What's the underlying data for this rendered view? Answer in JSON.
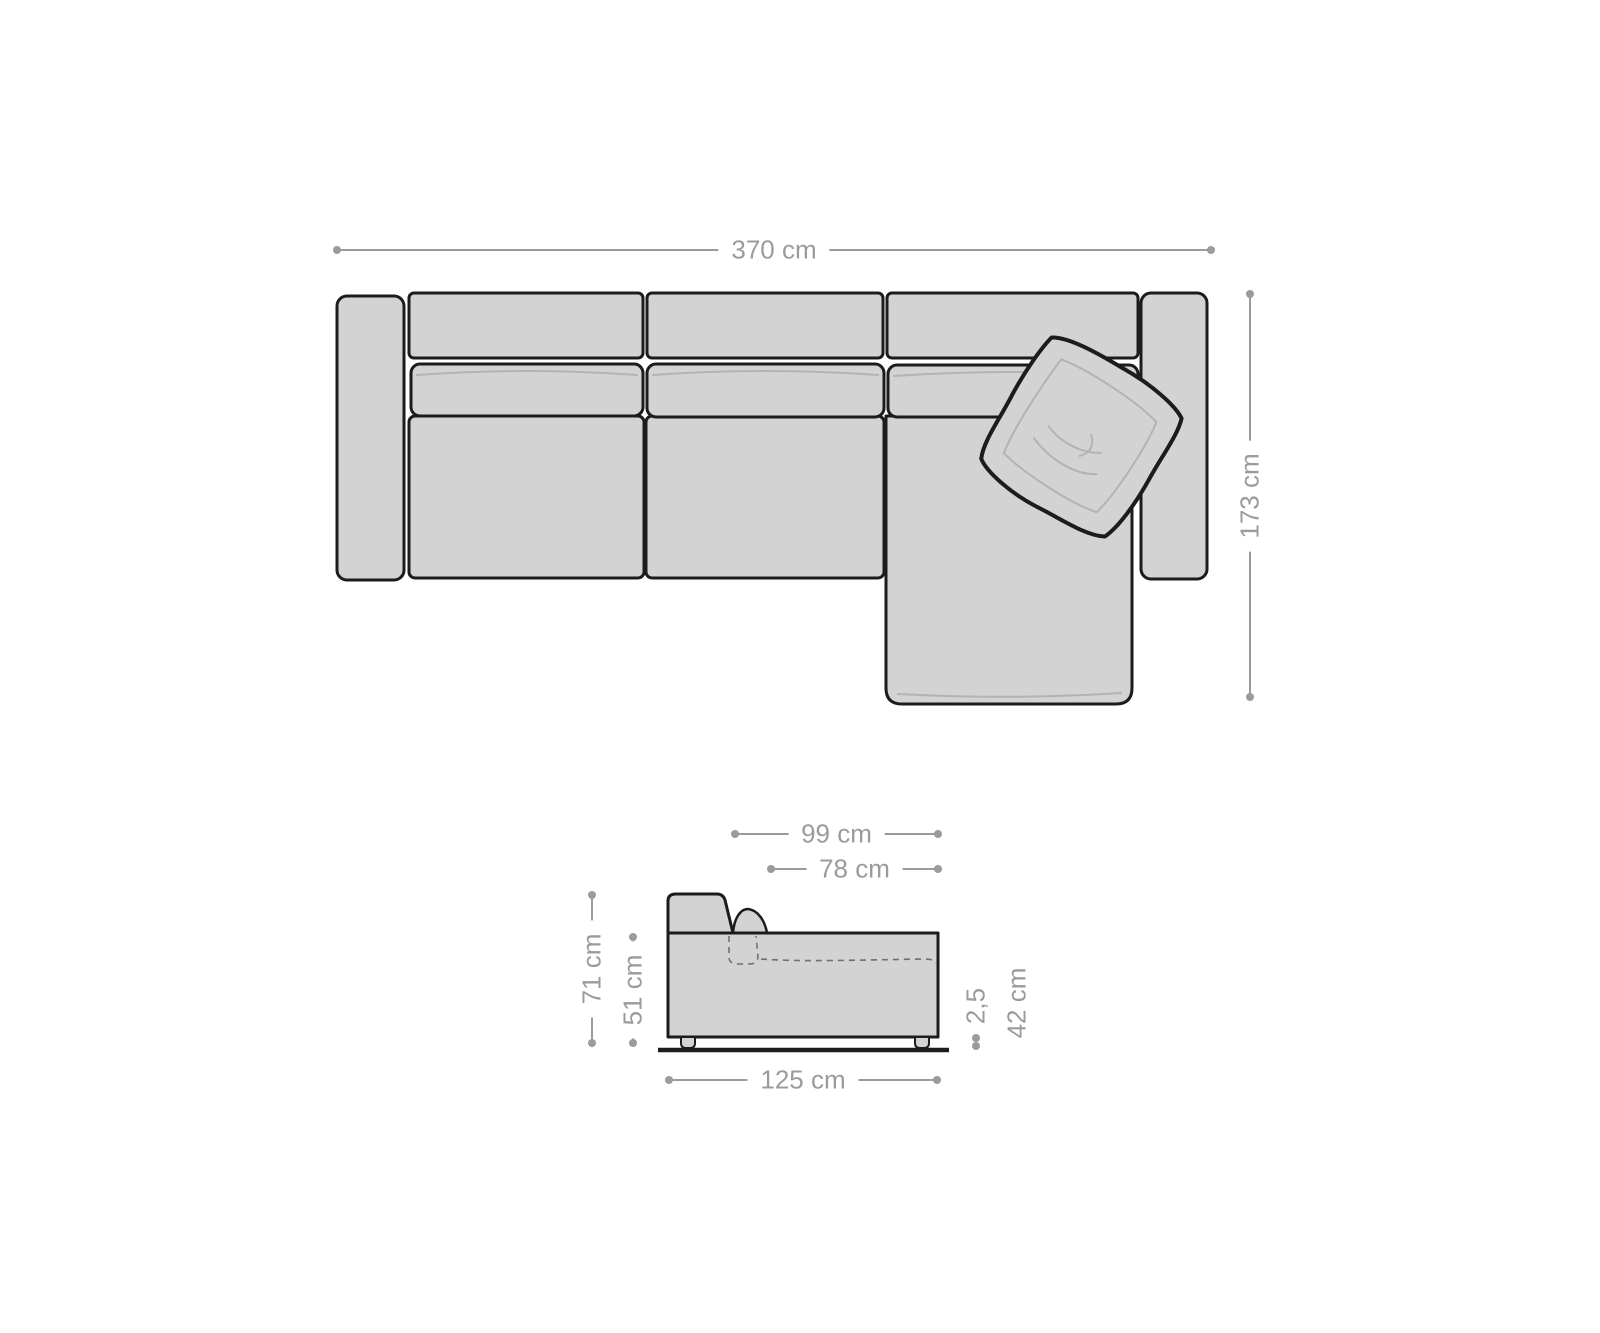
{
  "page": {
    "background": "#ffffff",
    "description_labels_units": "cm"
  },
  "colors": {
    "outline": "#1c1c1c",
    "sofa_fill": "#d3d3d3",
    "dimension_gray": "#9b9b9b",
    "seam_gray": "#b3b3b3"
  },
  "top_view": {
    "dimensions": {
      "width": "370 cm",
      "depth": "173 cm"
    }
  },
  "side_view": {
    "dimensions": {
      "chaise_total_depth": "99 cm",
      "chaise_inner_depth": "78 cm",
      "back_height": "71 cm",
      "body_height": "51 cm",
      "ground_clearance": "2,5",
      "seat_height": "42 cm",
      "width": "125 cm"
    }
  }
}
